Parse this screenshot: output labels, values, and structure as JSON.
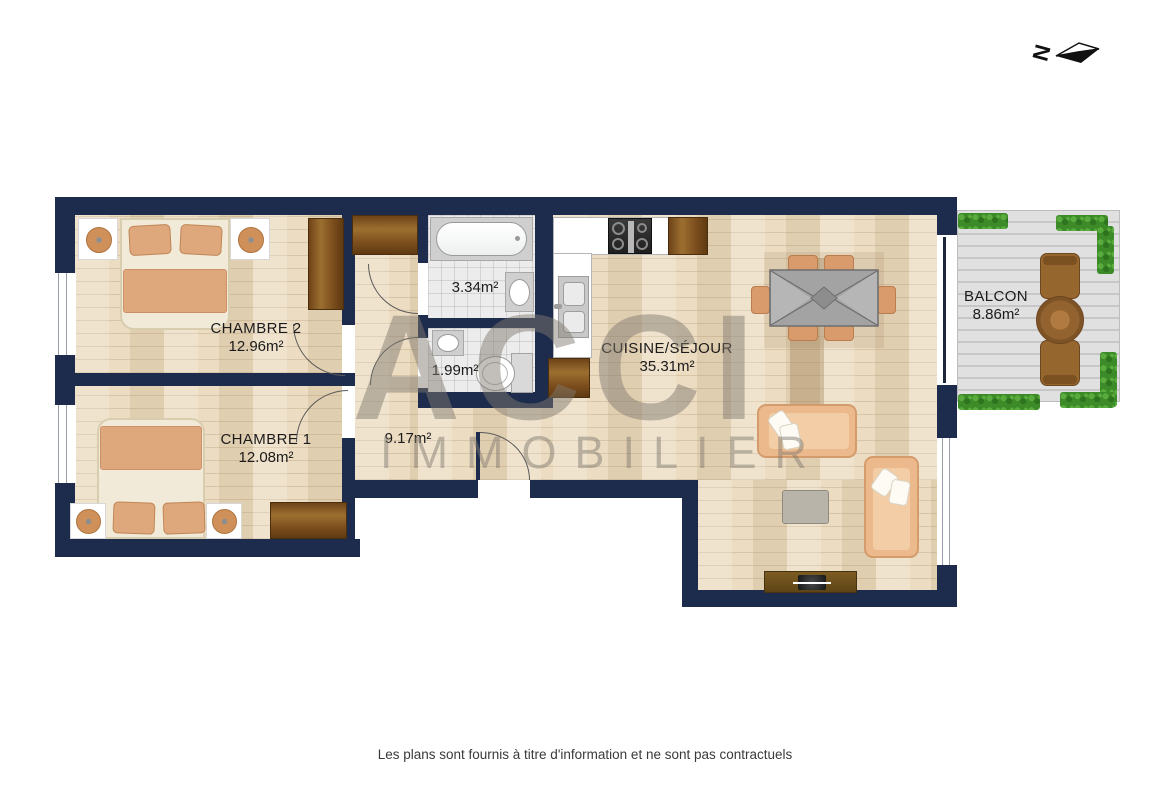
{
  "compass": {
    "north_label": "N"
  },
  "watermark": {
    "line1": "ACCI",
    "line2": "IMMOBILIER"
  },
  "rooms": {
    "chambre2": {
      "name": "CHAMBRE 2",
      "area": "12.96m²"
    },
    "chambre1": {
      "name": "CHAMBRE 1",
      "area": "12.08m²"
    },
    "bathroom": {
      "area": "3.34m²"
    },
    "wc": {
      "area": "1.99m²"
    },
    "hallway": {
      "area": "9.17m²"
    },
    "sejour": {
      "name": "CUISINE/SÉJOUR",
      "area": "35.31m²"
    },
    "balcon": {
      "name": "BALCON",
      "area": "8.86m²"
    }
  },
  "footer": {
    "disclaimer": "Les plans sont fournis à titre d'information et ne sont pas contractuels"
  },
  "colors": {
    "wall": "#1d2c4d",
    "wood": "#ecdcc2",
    "hedge": "#3c8a28",
    "fabric": "#dfa87c"
  }
}
